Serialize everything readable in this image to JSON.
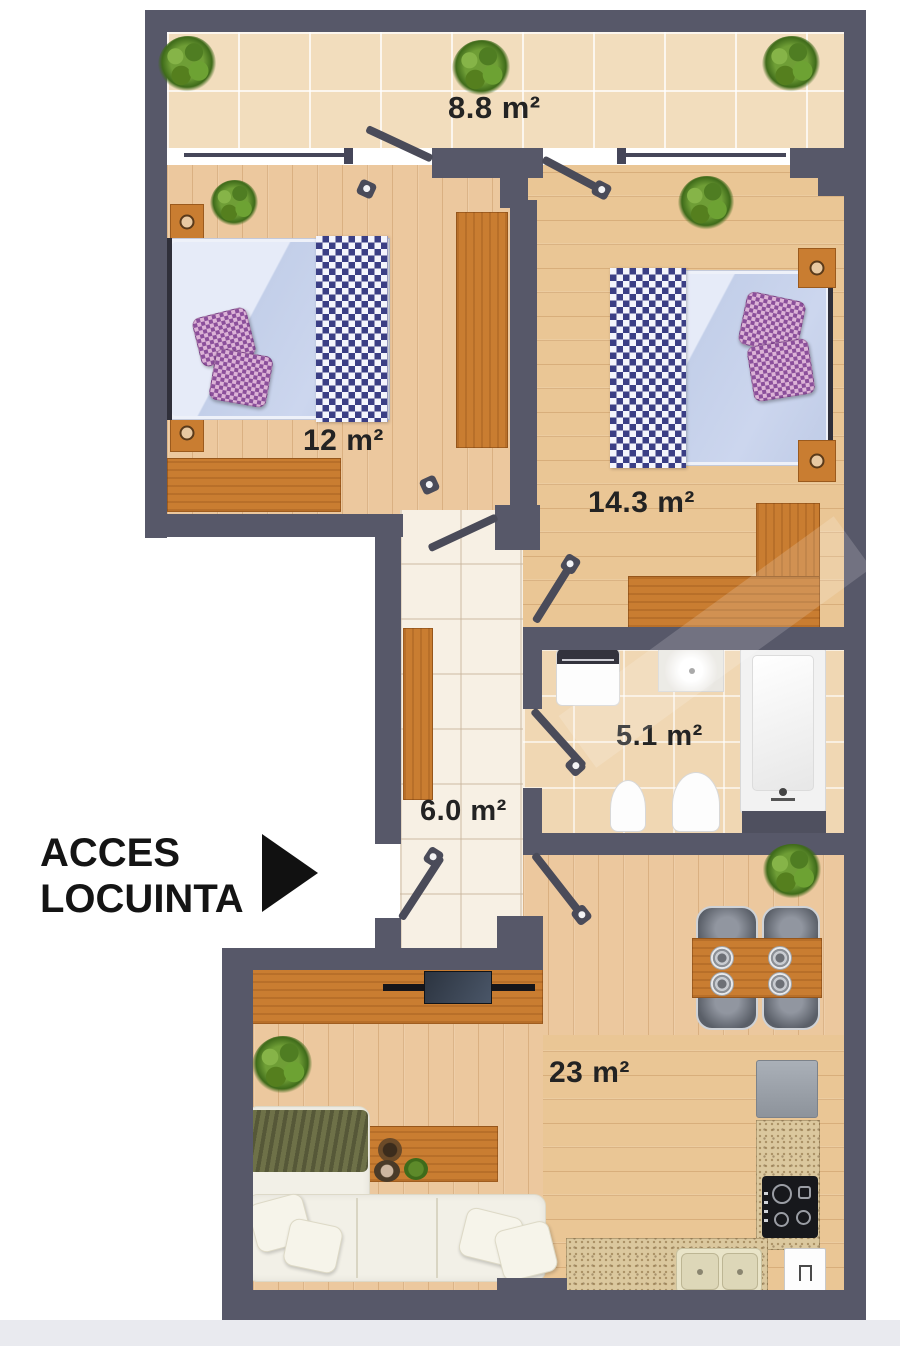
{
  "access": {
    "line1": "ACCES",
    "line2": "LOCUINTA"
  },
  "rooms": {
    "balcony": {
      "area_label": "8.8 m²"
    },
    "bedroom_left": {
      "area_label": "12 m²"
    },
    "bedroom_right": {
      "area_label": "14.3 m²"
    },
    "bathroom": {
      "area_label": "5.1 m²"
    },
    "hallway": {
      "area_label": "6.0 m²"
    },
    "living_kitchen": {
      "area_label": "23 m²"
    }
  },
  "colors": {
    "wall": "#575869",
    "wood_floor": "#ecc89e",
    "balcony_tile": "#f2ddbd",
    "bathroom_tile": "#f0d7b3",
    "hallway_tile": "#f7f0e4",
    "furniture_orange": "#c97d31",
    "bedding_blue": "#ccd6ee",
    "bedding_checker_navy": "#3b3f85",
    "pillow_purple": "#8b4f9b",
    "plant_green": "#6f9e36",
    "label_text": "#232323"
  }
}
